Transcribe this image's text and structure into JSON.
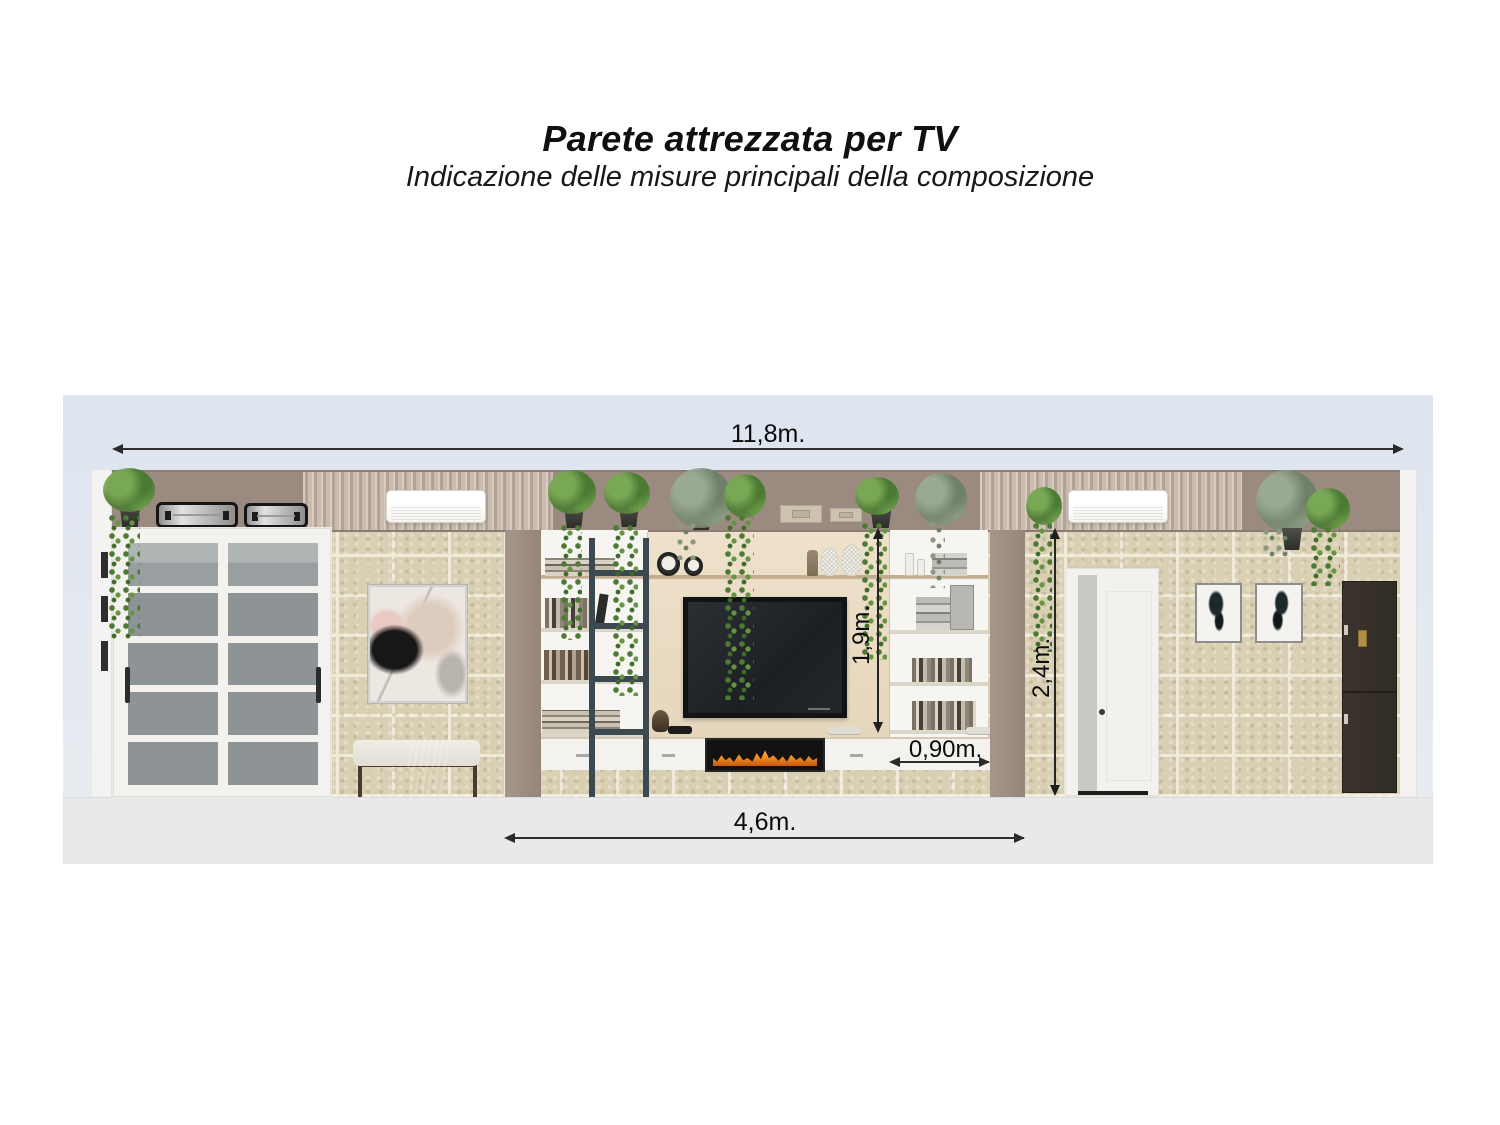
{
  "title": "Parete attrezzata per TV",
  "subtitle": "Indicazione delle misure principali della composizione",
  "dimensions": {
    "total_width": "11,8m.",
    "composition_width": "4,6m.",
    "niche_height": "1,9m.",
    "wall_height": "2,4m.",
    "right_section_width": "0,90m."
  },
  "colors": {
    "canvas_background": "#dde4ef",
    "floor": "#e8e9ea",
    "upper_band": "#9a8a80",
    "stone_wall": "#d9cfb2",
    "column": "#9d8d82",
    "tv_back_panel": "#e8d9c1",
    "unit_white": "#f6f5f1",
    "ladder": "#3c4950",
    "flame": "#ff9a26",
    "dimension_line": "#2a2a2a"
  }
}
